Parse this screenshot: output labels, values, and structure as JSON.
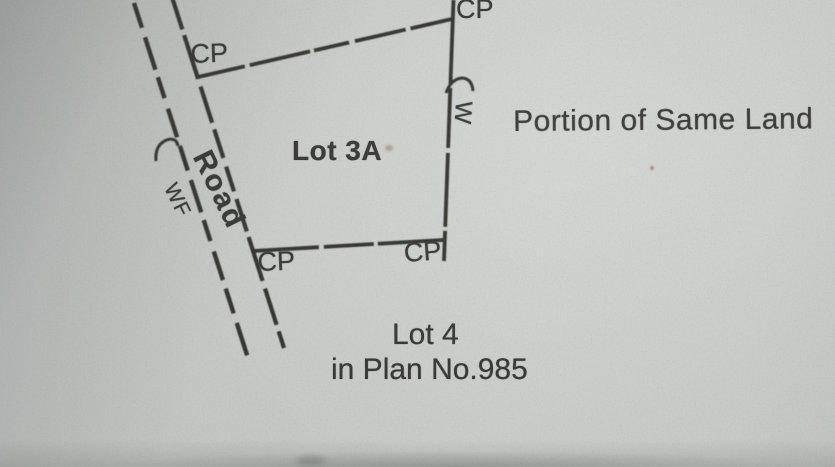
{
  "plan": {
    "lot_label": "Lot 3A",
    "road_label": "Road",
    "road_fence_mark": "WF",
    "east_boundary_fence_mark": "W",
    "corner_points": {
      "north_west": "CP",
      "north_east": "CP",
      "south_west": "CP",
      "south_east": "CP"
    },
    "east_note": "Portion of Same Land",
    "south_caption": {
      "line1": "Lot 4",
      "line2": "in Plan No.985"
    }
  },
  "colors": {
    "ink": "#21211f",
    "paper": "#cdd0cc"
  }
}
